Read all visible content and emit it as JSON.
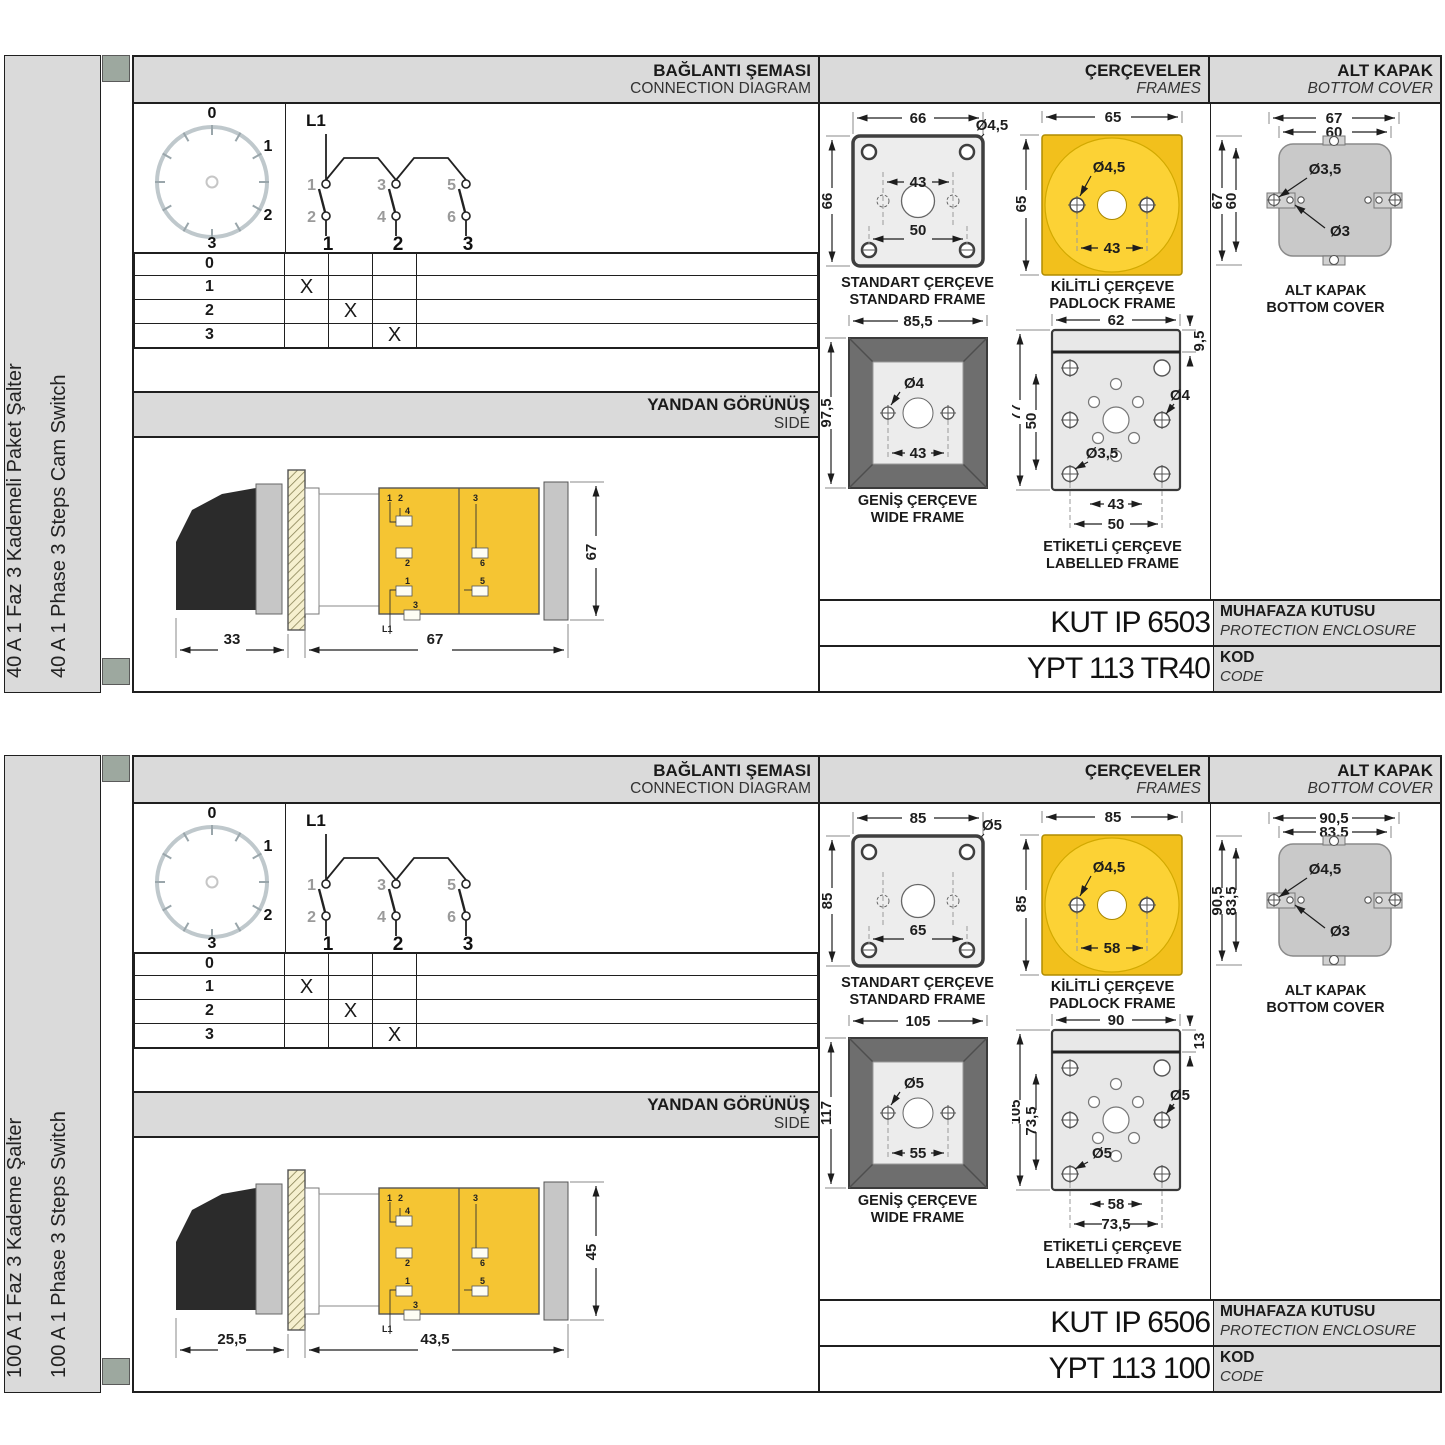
{
  "sections": [
    {
      "side_label_tr": "40 A 1 Faz 3 Kademeli Paket Şalter",
      "side_label_en": "40 A 1 Phase 3 Steps Cam Switch",
      "headers": {
        "connection_tr": "BAĞLANTI ŞEMASI",
        "connection_en": "CONNECTION DIAGRAM",
        "frames_tr": "ÇERÇEVELER",
        "frames_en": "FRAMES",
        "cover_tr": "ALT KAPAK",
        "cover_en": "BOTTOM COVER"
      },
      "dial": {
        "positions": [
          "0",
          "1",
          "2",
          "3"
        ]
      },
      "circuit": {
        "line_label": "L1",
        "top_terminals": [
          "1",
          "3",
          "5"
        ],
        "bottom_terminals": [
          "2",
          "4",
          "6"
        ],
        "outputs": [
          "1",
          "2",
          "3"
        ]
      },
      "switch_table": {
        "rows": [
          {
            "pos": "0",
            "marks": [
              "",
              "",
              ""
            ]
          },
          {
            "pos": "1",
            "marks": [
              "X",
              "",
              ""
            ]
          },
          {
            "pos": "2",
            "marks": [
              "",
              "X",
              ""
            ]
          },
          {
            "pos": "3",
            "marks": [
              "",
              "",
              "X"
            ]
          }
        ]
      },
      "side_view": {
        "title_tr": "YANDAN GÖRÜNÜŞ",
        "title_en": "SIDE",
        "handle_depth": "33",
        "body_depth": "67",
        "height": "67",
        "body_labels": [
          "1",
          "2",
          "4",
          "2",
          "3",
          "6",
          "1",
          "5",
          "3",
          "L1"
        ]
      },
      "frames": {
        "standard": {
          "title_tr": "STANDART ÇERÇEVE",
          "title_en": "STANDARD FRAME",
          "width": "66",
          "height": "66",
          "hole_dia": "Ø4,5",
          "mid_span": "43",
          "bottom_span": "50"
        },
        "padlock": {
          "title_tr": "KİLİTLİ ÇERÇEVE",
          "title_en": "PADLOCK FRAME",
          "width": "65",
          "height": "65",
          "hole_dia": "Ø4,5",
          "span": "43"
        },
        "wide": {
          "title_tr": "GENİŞ ÇERÇEVE",
          "title_en": "WIDE FRAME",
          "width": "85,5",
          "height": "97,5",
          "hole_dia": "Ø4",
          "span": "43"
        },
        "labelled": {
          "title_tr": "ETİKETLİ ÇERÇEVE",
          "title_en": "LABELLED FRAME",
          "width": "62",
          "strip_height": "9,5",
          "height": "77",
          "inner_span": "50",
          "hole_dia_right": "Ø4",
          "hole_dia_left": "Ø3,5",
          "span_inner": "43",
          "span_outer": "50"
        }
      },
      "bottom_cover": {
        "title_tr": "ALT KAPAK",
        "title_en": "BOTTOM COVER",
        "outer_width": "67",
        "inner_width": "60",
        "outer_height": "67",
        "inner_height": "60",
        "tab_hole_dia": "Ø3,5",
        "pin_hole_dia": "Ø3"
      },
      "enclosure": {
        "code": "KUT IP 6503",
        "label_tr": "MUHAFAZA KUTUSU",
        "label_en": "PROTECTION ENCLOSURE"
      },
      "product_code": {
        "code": "YPT 113 TR40",
        "label_tr": "KOD",
        "label_en": "CODE"
      }
    },
    {
      "side_label_tr": "100 A 1 Faz 3 Kademe Şalter",
      "side_label_en": "100 A 1 Phase 3 Steps Switch",
      "headers": {
        "connection_tr": "BAĞLANTI ŞEMASI",
        "connection_en": "CONNECTION DIAGRAM",
        "frames_tr": "ÇERÇEVELER",
        "frames_en": "FRAMES",
        "cover_tr": "ALT KAPAK",
        "cover_en": "BOTTOM COVER"
      },
      "dial": {
        "positions": [
          "0",
          "1",
          "2",
          "3"
        ]
      },
      "circuit": {
        "line_label": "L1",
        "top_terminals": [
          "1",
          "3",
          "5"
        ],
        "bottom_terminals": [
          "2",
          "4",
          "6"
        ],
        "outputs": [
          "1",
          "2",
          "3"
        ]
      },
      "switch_table": {
        "rows": [
          {
            "pos": "0",
            "marks": [
              "",
              "",
              ""
            ]
          },
          {
            "pos": "1",
            "marks": [
              "X",
              "",
              ""
            ]
          },
          {
            "pos": "2",
            "marks": [
              "",
              "X",
              ""
            ]
          },
          {
            "pos": "3",
            "marks": [
              "",
              "",
              "X"
            ]
          }
        ]
      },
      "side_view": {
        "title_tr": "YANDAN GÖRÜNÜŞ",
        "title_en": "SIDE",
        "handle_depth": "25,5",
        "body_depth": "43,5",
        "height": "45",
        "body_labels": [
          "1",
          "2",
          "4",
          "2",
          "3",
          "6",
          "1",
          "5",
          "3",
          "L1"
        ]
      },
      "frames": {
        "standard": {
          "title_tr": "STANDART ÇERÇEVE",
          "title_en": "STANDARD FRAME",
          "width": "85",
          "height": "85",
          "hole_dia": "Ø5",
          "mid_span": "",
          "bottom_span": "65"
        },
        "padlock": {
          "title_tr": "KİLİTLİ ÇERÇEVE",
          "title_en": "PADLOCK FRAME",
          "width": "85",
          "height": "85",
          "hole_dia": "Ø4,5",
          "span": "58"
        },
        "wide": {
          "title_tr": "GENİŞ ÇERÇEVE",
          "title_en": "WIDE FRAME",
          "width": "105",
          "height": "117",
          "hole_dia": "Ø5",
          "span": "55"
        },
        "labelled": {
          "title_tr": "ETİKETLİ ÇERÇEVE",
          "title_en": "LABELLED FRAME",
          "width": "90",
          "strip_height": "13",
          "height": "105",
          "inner_span": "73,5",
          "hole_dia_right": "Ø5",
          "hole_dia_left": "Ø5",
          "span_inner": "58",
          "span_outer": "73,5"
        }
      },
      "bottom_cover": {
        "title_tr": "ALT KAPAK",
        "title_en": "BOTTOM COVER",
        "outer_width": "90,5",
        "inner_width": "83,5",
        "outer_height": "90,5",
        "inner_height": "83,5",
        "tab_hole_dia": "Ø4,5",
        "pin_hole_dia": "Ø3"
      },
      "enclosure": {
        "code": "KUT IP 6506",
        "label_tr": "MUHAFAZA KUTUSU",
        "label_en": "PROTECTION ENCLOSURE"
      },
      "product_code": {
        "code": "YPT 113 100",
        "label_tr": "KOD",
        "label_en": "CODE"
      }
    }
  ]
}
